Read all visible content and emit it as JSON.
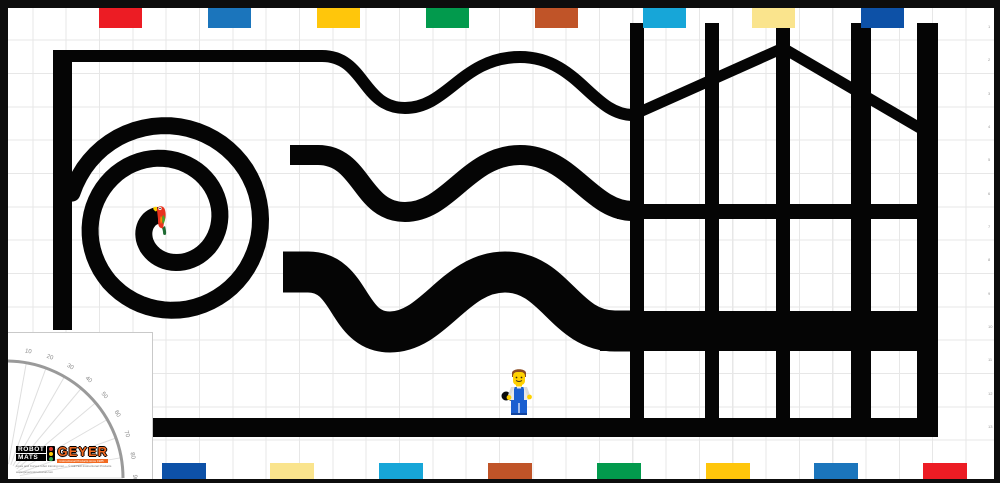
{
  "logo": {
    "word1": "ROBOT",
    "word2": "MATS",
    "brand": "GEYER",
    "tagline": "Instructional Products since 1985",
    "fineprint1": "Lines and Curves robot training mat — © GEYER Instructional Products",
    "fineprint2": "www.geyerinstructional.com",
    "brand_color": "#f26a21",
    "traffic_light_colors": [
      "#e03a2f",
      "#ffcb05",
      "#2fa64a"
    ]
  },
  "protractor": {
    "labels": [
      "0",
      "10",
      "20",
      "30",
      "40",
      "50",
      "60",
      "70",
      "80",
      "90"
    ],
    "arc_color": "#9a9a9a",
    "tick_color": "#dedede",
    "label_color": "#8a8a8a"
  },
  "bricks": {
    "top": [
      {
        "x": 99,
        "color": "#ec1c24"
      },
      {
        "x": 208,
        "color": "#1b75bc"
      },
      {
        "x": 317,
        "color": "#ffc60b"
      },
      {
        "x": 426,
        "color": "#029a4d"
      },
      {
        "x": 535,
        "color": "#c05428"
      },
      {
        "x": 643,
        "color": "#17a6d8"
      },
      {
        "x": 752,
        "color": "#fae48d"
      },
      {
        "x": 861,
        "color": "#0d51a7"
      }
    ],
    "bottom": [
      {
        "x": 162,
        "color": "#0d51a7"
      },
      {
        "x": 270,
        "color": "#fae48d"
      },
      {
        "x": 379,
        "color": "#17a6d8"
      },
      {
        "x": 488,
        "color": "#c05428"
      },
      {
        "x": 597,
        "color": "#029a4d"
      },
      {
        "x": 706,
        "color": "#ffc60b"
      },
      {
        "x": 814,
        "color": "#1b75bc"
      },
      {
        "x": 923,
        "color": "#ec1c24"
      }
    ]
  },
  "rulers": {
    "top_numbers": [
      1,
      2,
      3,
      4,
      5,
      6,
      7,
      8,
      9,
      10,
      11,
      12,
      13,
      14,
      15,
      16,
      17,
      18,
      19,
      20,
      21,
      22,
      23,
      24,
      25,
      26,
      27,
      28,
      29
    ],
    "right_numbers": [
      1,
      2,
      3,
      4,
      5,
      6,
      7,
      8,
      9,
      10,
      11,
      12,
      13
    ]
  },
  "path_color": "#050505"
}
